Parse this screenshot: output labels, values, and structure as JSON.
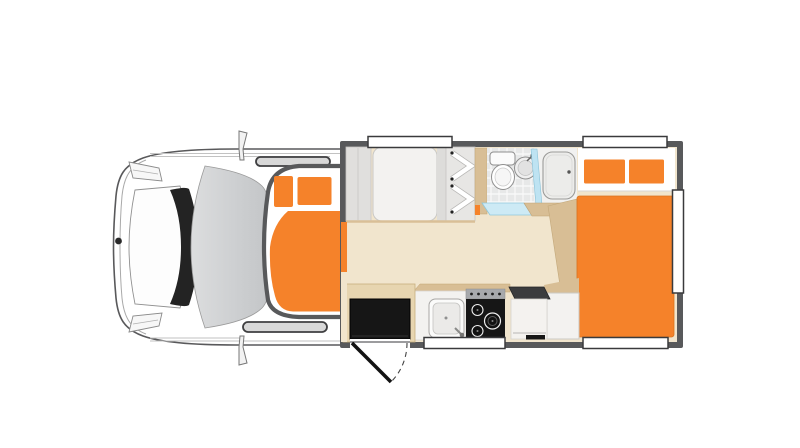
{
  "scene": {
    "kind": "motorhome-floorplan-top-view",
    "features": [
      {
        "id": "cab",
        "name": "driver-cab"
      },
      {
        "id": "windshield",
        "name": "windshield"
      },
      {
        "id": "mirrors",
        "name": "side-mirrors"
      },
      {
        "id": "overcab_bed",
        "name": "overcab-luton-bed"
      },
      {
        "id": "overcab_pillows",
        "name": "overcab-bed-pillows"
      },
      {
        "id": "front_bed",
        "name": "front-seating-bed"
      },
      {
        "id": "wardrobe",
        "name": "wardrobe-shelves"
      },
      {
        "id": "toilet",
        "name": "toilet"
      },
      {
        "id": "washbasin",
        "name": "washbasin"
      },
      {
        "id": "shower_screen",
        "name": "shower-glass-screen"
      },
      {
        "id": "shower_door",
        "name": "shower-cubicle-door"
      },
      {
        "id": "shower_tray",
        "name": "shower-tray-step"
      },
      {
        "id": "rear_bed",
        "name": "rear-double-bed"
      },
      {
        "id": "rear_pillows",
        "name": "rear-bed-pillows"
      },
      {
        "id": "kitchen_sink",
        "name": "kitchen-sink"
      },
      {
        "id": "cooktop",
        "name": "gas-cooktop"
      },
      {
        "id": "vent",
        "name": "counter-vent"
      },
      {
        "id": "cabinets",
        "name": "kitchen-cabinets"
      },
      {
        "id": "entry_step",
        "name": "entry-step"
      },
      {
        "id": "entry_door",
        "name": "entry-door-swing"
      },
      {
        "id": "windows",
        "name": "body-windows"
      }
    ]
  },
  "colors": {
    "accent_orange": "#F5822A",
    "orange_edge": "#DD6F1A",
    "floor_cream": "#F1E5CD",
    "counter_tan": "#D8BE95",
    "entry_tan": "#E7D5B0",
    "wall_gray": "#58595B",
    "appliance_black": "#161616",
    "vent_gray": "#3B3C3E",
    "knob_gray": "#A7A9AC",
    "furniture_white": "#F3F2F0",
    "furniture_gray": "#E0DFDD",
    "wardrobe_gray": "#E7E6E4",
    "glass_blue": "#BEE3F2",
    "tray_blue": "#CDEAF5",
    "tile_gray": "#E7E8E8",
    "cab_window_dark": "#3F3F41",
    "white": "#FFFFFF"
  }
}
